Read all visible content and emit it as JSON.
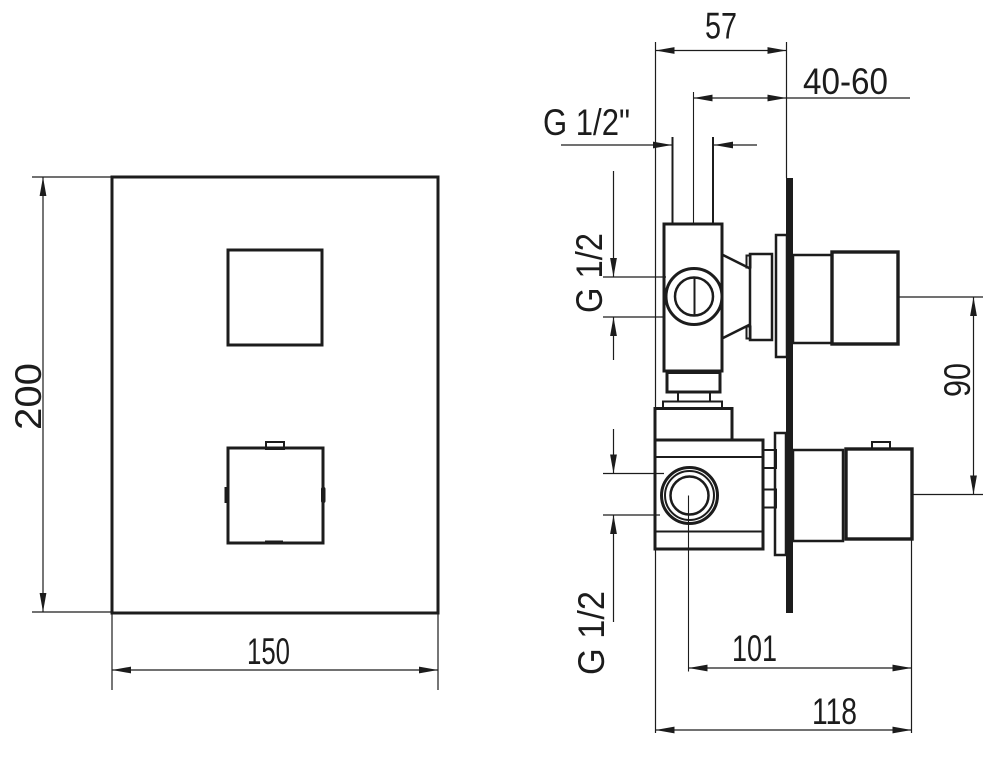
{
  "drawing": {
    "front_view": {
      "height_dim": "200",
      "width_dim": "150"
    },
    "side_view": {
      "depth_dim": "57",
      "wall_range_dim": "40-60",
      "top_inlet_thread": "G 1/2\"",
      "upper_port_thread": "G 1/2",
      "lower_port_thread": "G 1/2",
      "port_center_distance_dim": "90",
      "handle_to_center_dim": "101",
      "overall_depth_dim": "118"
    },
    "colors": {
      "line": "#1c1c1c",
      "background": "#ffffff"
    }
  }
}
